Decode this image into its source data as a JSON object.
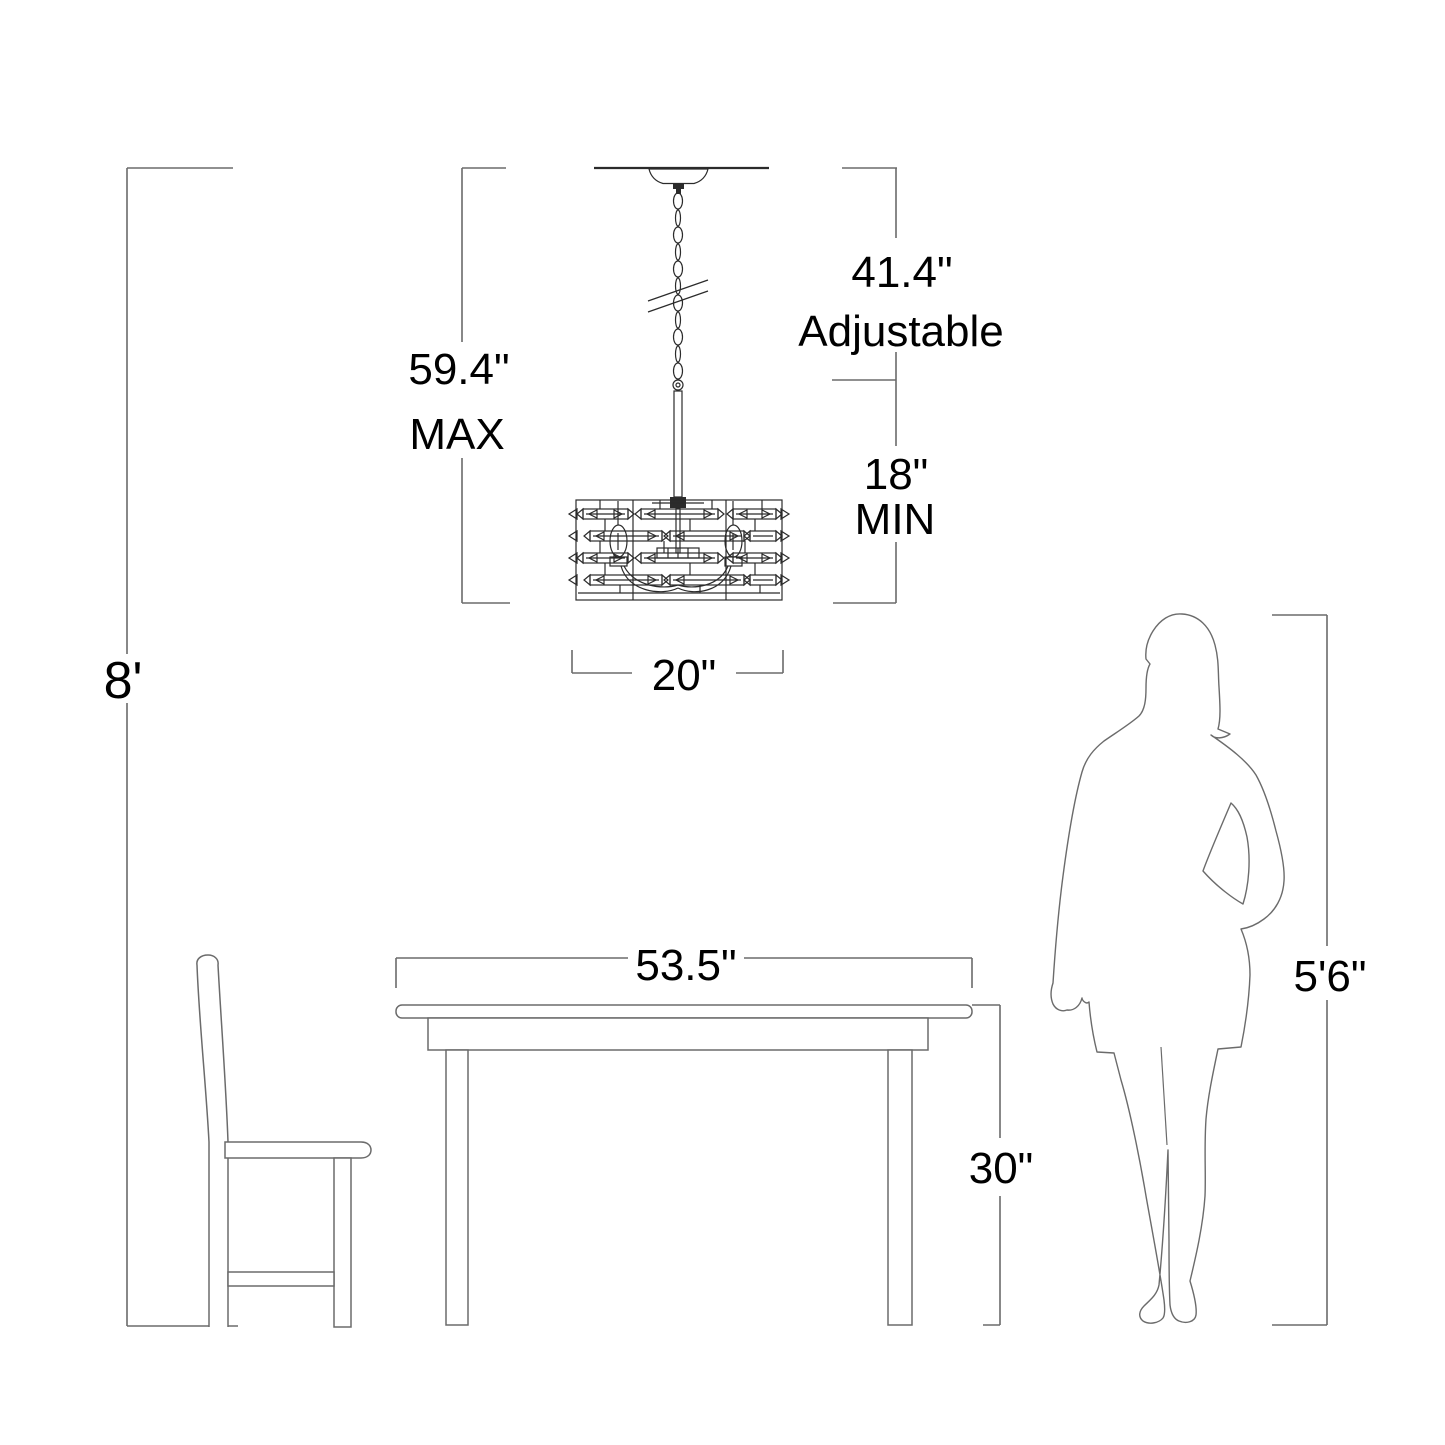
{
  "diagram": {
    "type": "product-dimension-diagram",
    "subject": "Chandelier hanging from ceiling above dining table with chair and woman silhouette for scale"
  },
  "labels": {
    "ceiling_height": "8'",
    "max_drop_value": "59.4\"",
    "max_drop_qualifier": "MAX",
    "adjustable_value": "41.4\"",
    "adjustable_qualifier": "Adjustable",
    "min_drop_value": "18\"",
    "min_drop_qualifier": "MIN",
    "fixture_width": "20\"",
    "table_width": "53.5\"",
    "table_height": "30\"",
    "person_height": "5'6\""
  },
  "style": {
    "bg": "#ffffff",
    "line-color": "#6b6b6b",
    "dark-line-color": "#2b2b2b",
    "text-color": "#000000"
  }
}
